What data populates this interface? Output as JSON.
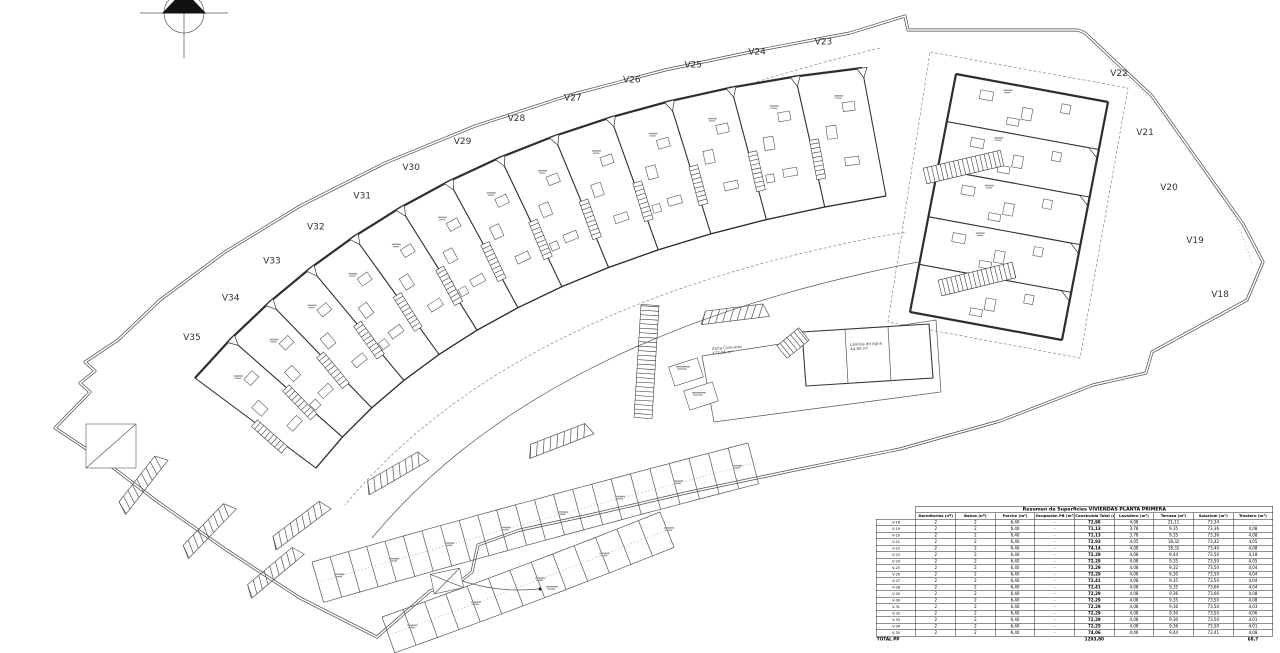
{
  "drawing": {
    "kind": "architectural site plan",
    "floor": "planta primera",
    "villa_labels_band": [
      "V23",
      "V24",
      "V25",
      "V26",
      "V27",
      "V28",
      "V29",
      "V30",
      "V31",
      "V32",
      "V33",
      "V34",
      "V35"
    ],
    "villa_labels_block": [
      "V22",
      "V21",
      "V20",
      "V19",
      "V18"
    ],
    "zone_labels": {
      "common_zone": "Zona Comunes\n472,95 m²",
      "pool": "Lámina de agua\n44,90 m²"
    }
  },
  "table": {
    "title": "Resumen de Superficies VIVIENDAS PLANTA PRIMERA",
    "columns": [
      "",
      "Dormitorios (nº)",
      "Baños (nº)",
      "Porche (m²)",
      "Ocupación PB (m²)",
      "Construida Total (m²)",
      "Lavadero (m²)",
      "Terraza (m²)",
      "Solarium (m²)",
      "Trastero (m²)"
    ],
    "rows": [
      [
        "V-18",
        "2",
        "2",
        "6,40",
        "-",
        "72,98",
        "4,08",
        "21,11",
        "73,34",
        "-"
      ],
      [
        "V-19",
        "2",
        "2",
        "6,40",
        "-",
        "71,13",
        "3,78",
        "9,35",
        "73,36",
        "4,08"
      ],
      [
        "V-20",
        "2",
        "2",
        "6,40",
        "-",
        "71,13",
        "3,78",
        "9,35",
        "73,36",
        "4,08"
      ],
      [
        "V-21",
        "2",
        "2",
        "6,40",
        "-",
        "72,93",
        "4,05",
        "18,32",
        "73,42",
        "4,05"
      ],
      [
        "V-22",
        "2",
        "2",
        "6,40",
        "-",
        "74,14",
        "4,08",
        "18,32",
        "73,40",
        "4,08"
      ],
      [
        "V-23",
        "2",
        "2",
        "6,40",
        "-",
        "72,29",
        "4,08",
        "9,44",
        "73,50",
        "4,18"
      ],
      [
        "V-24",
        "2",
        "2",
        "6,40",
        "-",
        "72,29",
        "4,08",
        "9,35",
        "73,50",
        "4,05"
      ],
      [
        "V-25",
        "2",
        "2",
        "6,40",
        "-",
        "72,29",
        "4,08",
        "9,32",
        "73,50",
        "4,04"
      ],
      [
        "V-26",
        "2",
        "2",
        "6,40",
        "-",
        "72,29",
        "4,08",
        "9,30",
        "73,50",
        "4,04"
      ],
      [
        "V-27",
        "2",
        "2",
        "6,40",
        "-",
        "72,41",
        "4,08",
        "9,35",
        "73,50",
        "4,04"
      ],
      [
        "V-28",
        "2",
        "2",
        "6,40",
        "-",
        "72,41",
        "4,08",
        "9,35",
        "73,66",
        "4,04"
      ],
      [
        "V-29",
        "2",
        "2",
        "6,40",
        "-",
        "72,29",
        "4,08",
        "9,36",
        "73,66",
        "4,08"
      ],
      [
        "V-30",
        "2",
        "2",
        "6,40",
        "-",
        "72,29",
        "4,08",
        "9,35",
        "73,50",
        "4,08"
      ],
      [
        "V-31",
        "2",
        "2",
        "6,40",
        "-",
        "72,29",
        "4,08",
        "9,36",
        "73,50",
        "4,03"
      ],
      [
        "V-32",
        "2",
        "2",
        "6,40",
        "-",
        "72,29",
        "4,08",
        "9,30",
        "73,50",
        "4,06"
      ],
      [
        "V-33",
        "2",
        "2",
        "6,40",
        "-",
        "72,29",
        "4,08",
        "9,30",
        "73,50",
        "4,01"
      ],
      [
        "V-34",
        "2",
        "2",
        "6,40",
        "-",
        "72,25",
        "4,08",
        "9,36",
        "73,50",
        "4,01"
      ],
      [
        "V-35",
        "2",
        "2",
        "6,40",
        "-",
        "74,06",
        "4,46",
        "9,44",
        "73,41",
        "4,08"
      ]
    ],
    "total_row": {
      "label": "TOTAL PP",
      "construida_total": "1293,80",
      "trastero_total": "68,7"
    }
  }
}
